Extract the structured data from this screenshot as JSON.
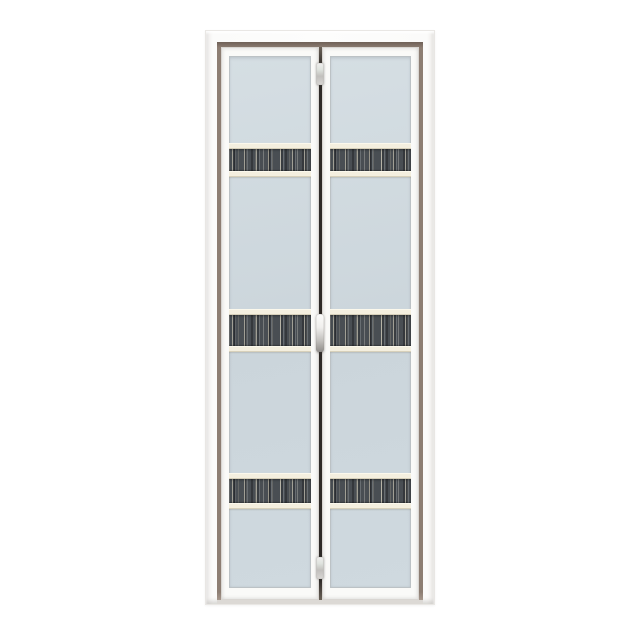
{
  "scene": {
    "description": "Product photograph of a white aluminium-framed bi-fold door with two folding leaves, frosted light blue-grey glass panels and three horizontal dark wood-grain decorative glass strips on each leaf",
    "background": "plain white",
    "visible_text": "none"
  },
  "door": {
    "frame_rect": {
      "x": 205,
      "y": 30,
      "width": 230,
      "height": 575
    },
    "leaf_count": 2,
    "strips_per_leaf": 3,
    "strips": [
      {
        "top": 87,
        "height": 34
      },
      {
        "top": 253,
        "height": 43
      },
      {
        "top": 417,
        "height": 36
      }
    ],
    "hardware": {
      "top_hinge": {
        "top": 16,
        "height": 22
      },
      "handle": {
        "top": 267,
        "height": 38
      },
      "bottom_hinge": {
        "top": 510,
        "height": 22
      }
    }
  },
  "colors": {
    "bg": "#ffffff",
    "frame-edge": "#e9e7e4",
    "reveal-dark": "#6f6157",
    "reveal-mid": "#8d7e73",
    "reveal-light": "#b3a499",
    "sill-light": "#dcd9d5",
    "leaf-white": "#fafaf8",
    "leaf-edge": "#d9d6d2",
    "glass-light": "#d5dee3",
    "glass-base": "#cbd5db",
    "glass-edge": "#bcc2c5",
    "cream": "#f4efdf",
    "cream-edge": "#d7d0ba",
    "grain-base": "#494e53",
    "gap-dark": "#2e2a27",
    "metal-light": "#f0efed",
    "metal-mid": "#c2c0bd",
    "metal-dark": "#908d8a"
  }
}
